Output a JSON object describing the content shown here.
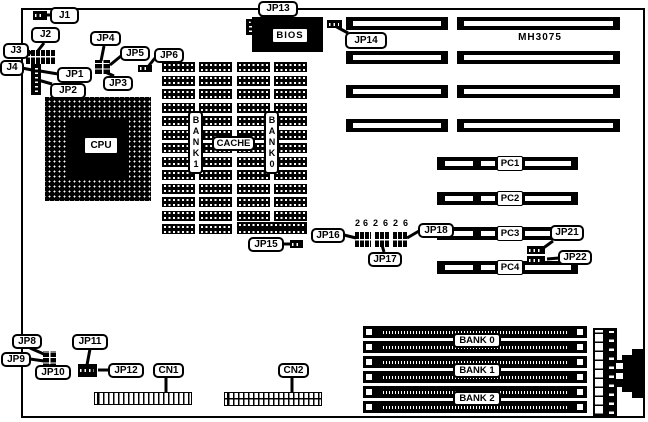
{
  "board": {
    "model": "MH3075"
  },
  "chips": {
    "cpu": "CPU",
    "bios": "BIOS",
    "cache": "CACHE",
    "bank1": "BANK1",
    "bank0": "BANK0"
  },
  "jumpers": {
    "j1": "J1",
    "j2": "J2",
    "j3": "J3",
    "j4": "J4",
    "jp1": "JP1",
    "jp2": "JP2",
    "jp3": "JP3",
    "jp4": "JP4",
    "jp5": "JP5",
    "jp6": "JP6",
    "jp8": "JP8",
    "jp9": "JP9",
    "jp10": "JP10",
    "jp11": "JP11",
    "jp12": "JP12",
    "jp13": "JP13",
    "jp14": "JP14",
    "jp15": "JP15",
    "jp16": "JP16",
    "jp17": "JP17",
    "jp18": "JP18",
    "jp21": "JP21",
    "jp22": "JP22"
  },
  "connectors": {
    "cn1": "CN1",
    "cn2": "CN2"
  },
  "pc_slots": [
    "PC1",
    "PC2",
    "PC3",
    "PC4"
  ],
  "simm_banks": [
    "BANK 0",
    "BANK 1",
    "BANK 2"
  ],
  "pin_numbers": [
    "2",
    "6",
    "2",
    "6",
    "2",
    "6"
  ]
}
